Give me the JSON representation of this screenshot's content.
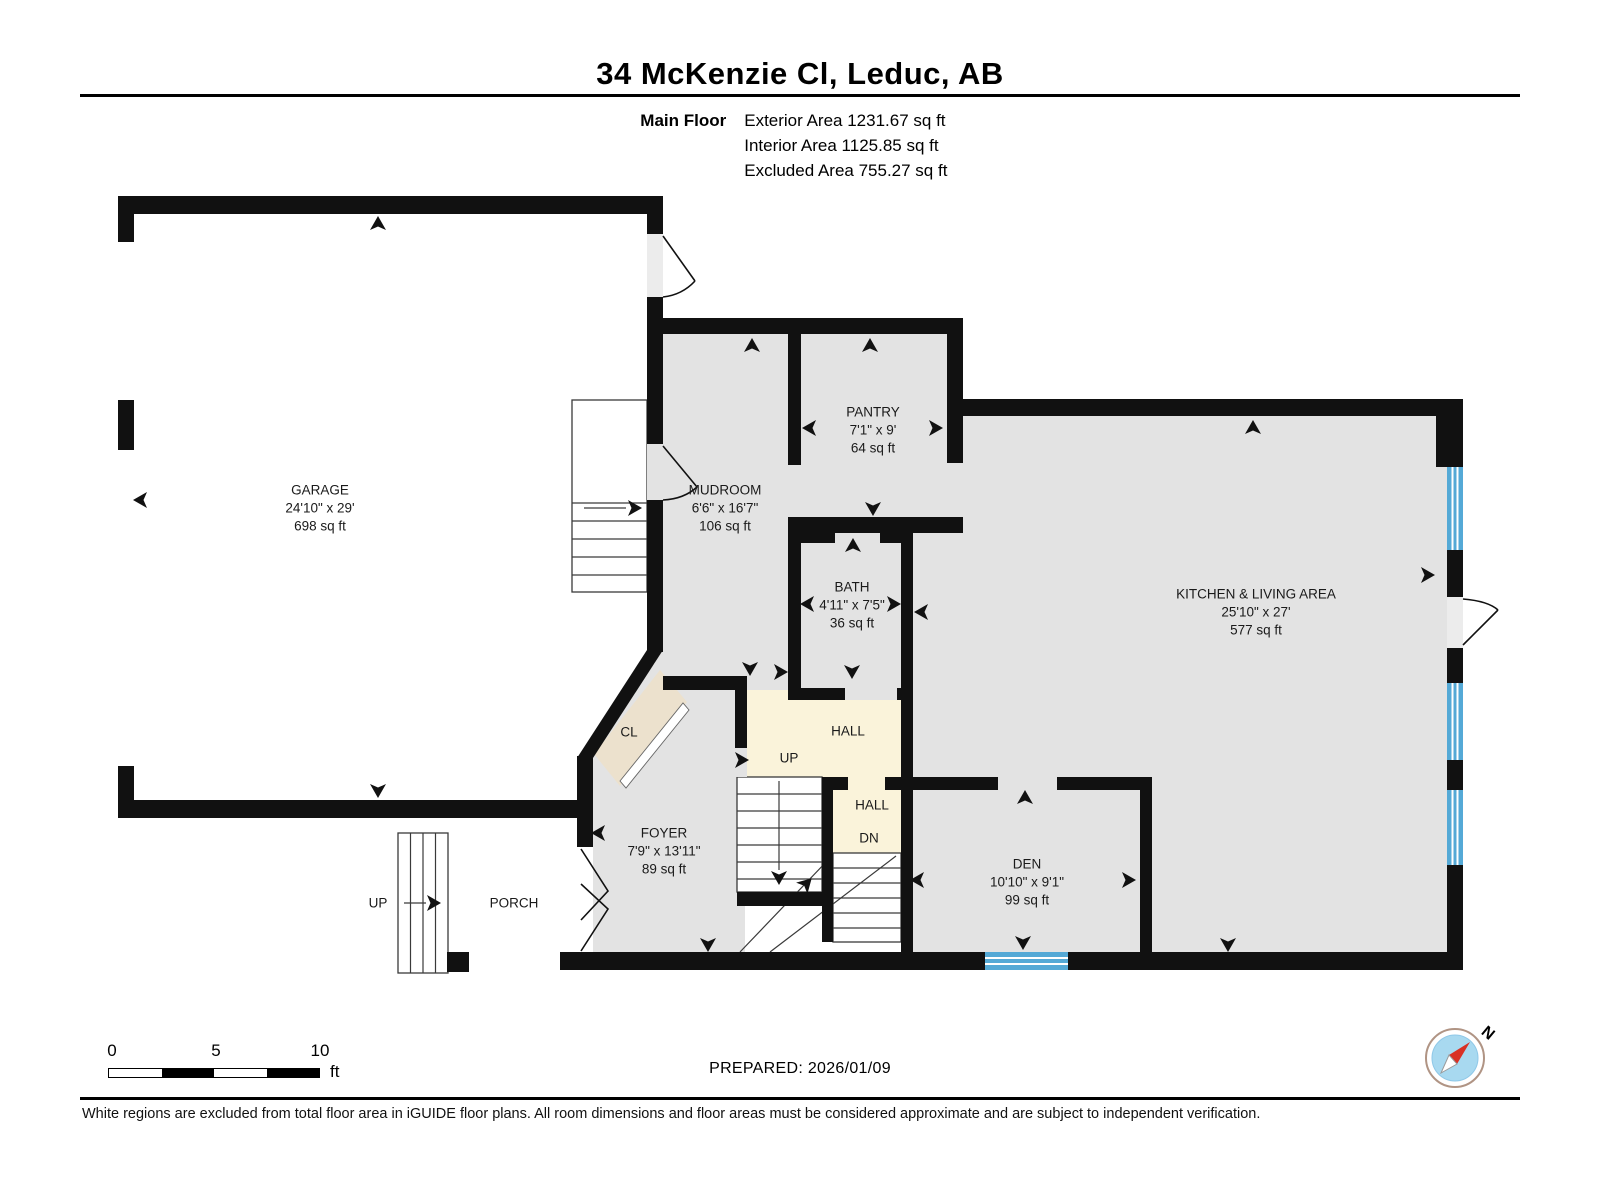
{
  "header": {
    "title": "34 McKenzie Cl, Leduc, AB",
    "floor_label": "Main Floor",
    "area_lines": [
      "Exterior Area 1231.67 sq ft",
      "Interior Area 1125.85 sq ft",
      "Excluded Area 755.27 sq ft"
    ]
  },
  "rooms": [
    {
      "id": "garage",
      "name": "GARAGE",
      "dims": "24'10\" x 29'",
      "area": "698 sq ft",
      "x": 320,
      "y": 508
    },
    {
      "id": "mudroom",
      "name": "MUDROOM",
      "dims": "6'6\" x 16'7\"",
      "area": "106 sq ft",
      "x": 725,
      "y": 508
    },
    {
      "id": "pantry",
      "name": "PANTRY",
      "dims": "7'1\" x 9'",
      "area": "64 sq ft",
      "x": 873,
      "y": 430
    },
    {
      "id": "bath",
      "name": "BATH",
      "dims": "4'11\" x 7'5\"",
      "area": "36 sq ft",
      "x": 852,
      "y": 605
    },
    {
      "id": "kitchen-living",
      "name": "KITCHEN & LIVING AREA",
      "dims": "25'10\" x 27'",
      "area": "577 sq ft",
      "x": 1256,
      "y": 612
    },
    {
      "id": "foyer",
      "name": "FOYER",
      "dims": "7'9\" x 13'11\"",
      "area": "89 sq ft",
      "x": 664,
      "y": 851
    },
    {
      "id": "den",
      "name": "DEN",
      "dims": "10'10\" x 9'1\"",
      "area": "99 sq ft",
      "x": 1027,
      "y": 882
    }
  ],
  "plan_labels": [
    {
      "id": "closet",
      "text": "CL",
      "x": 629,
      "y": 732
    },
    {
      "id": "hall-upper",
      "text": "HALL",
      "x": 848,
      "y": 731
    },
    {
      "id": "up-main-stairs",
      "text": "UP",
      "x": 789,
      "y": 758
    },
    {
      "id": "hall-lower",
      "text": "HALL",
      "x": 872,
      "y": 805
    },
    {
      "id": "dn-stairs",
      "text": "DN",
      "x": 869,
      "y": 838
    },
    {
      "id": "porch",
      "text": "PORCH",
      "x": 514,
      "y": 903
    },
    {
      "id": "up-porch",
      "text": "UP",
      "x": 378,
      "y": 903
    }
  ],
  "scale_bar": {
    "ticks": [
      "0",
      "5",
      "10"
    ],
    "unit": "ft"
  },
  "footer": {
    "prepared": "PREPARED: 2026/01/09",
    "disclaimer": "White regions are excluded from total floor area in iGUIDE floor plans. All room dimensions and floor areas must be considered approximate and are subject to independent verification."
  },
  "compass": {
    "north_label": "N"
  },
  "colors": {
    "wall": "#111111",
    "floor": "#e3e3e3",
    "hall_floor": "#faf3da",
    "closet_floor": "#ece1cd",
    "window": "#54a9d6",
    "compass_disc": "#a8d9f0",
    "compass_needle": "#d93025"
  }
}
